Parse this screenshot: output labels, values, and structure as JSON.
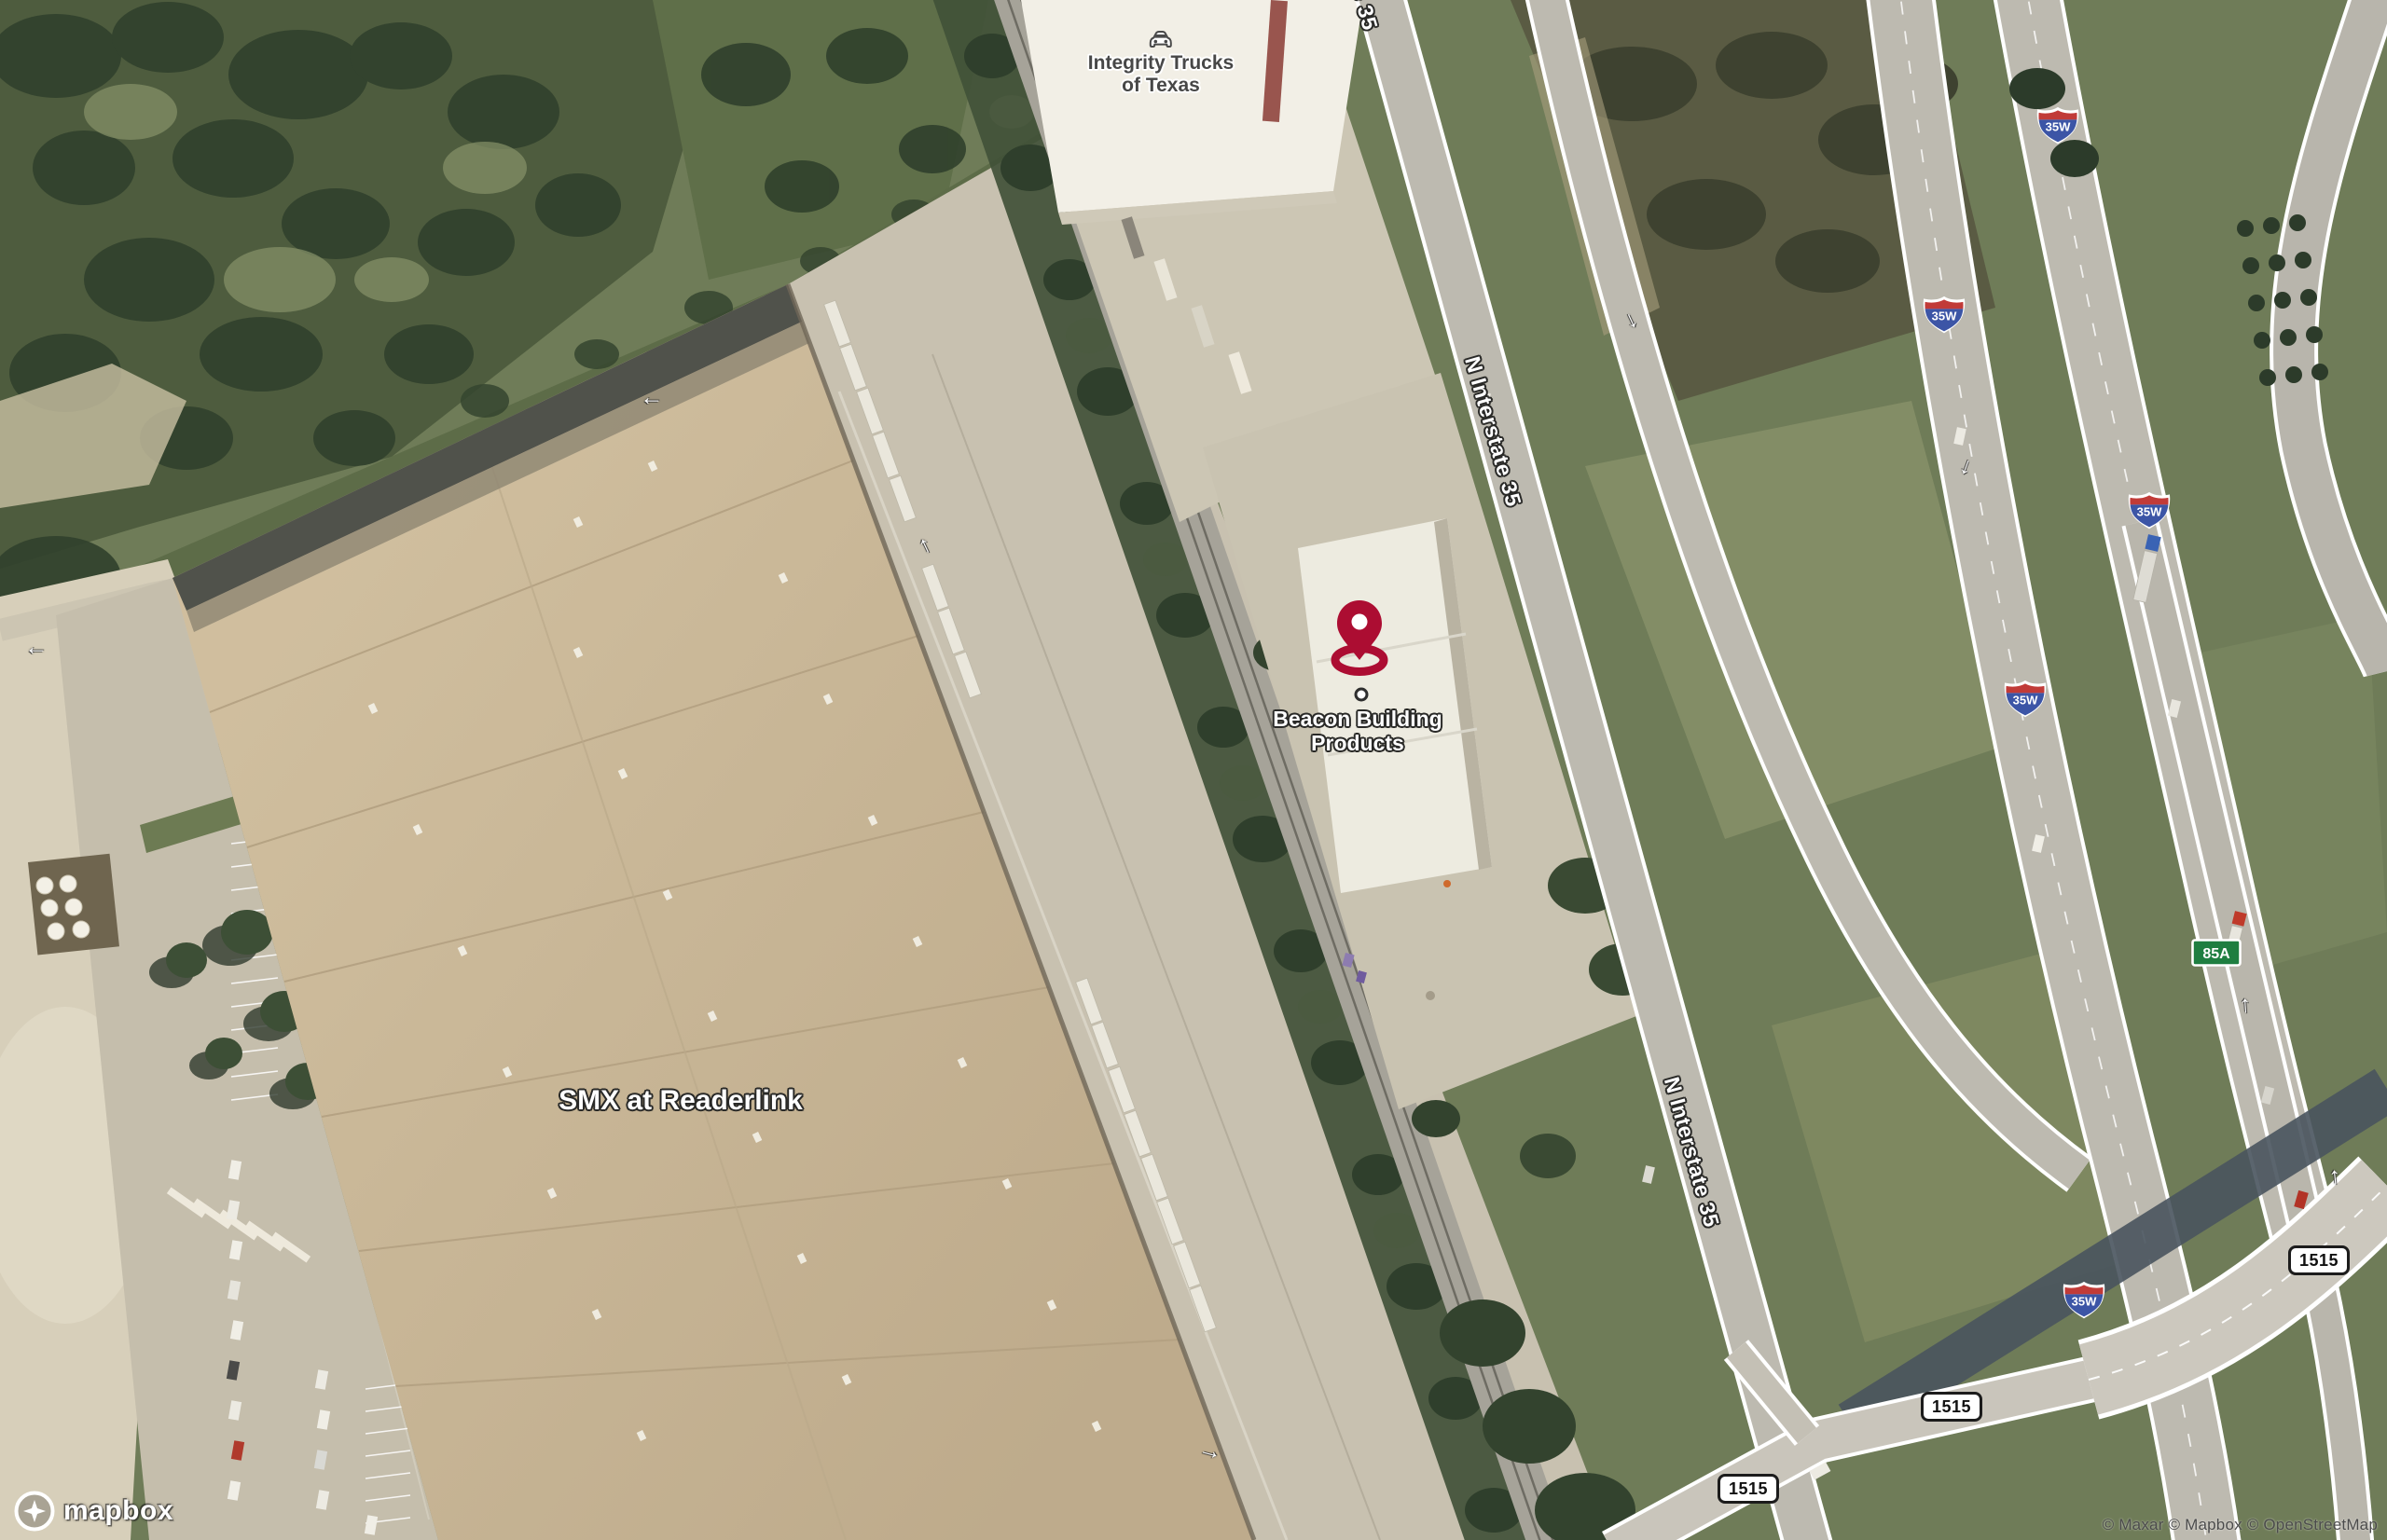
{
  "map": {
    "attribution_text": "© Maxar © Mapbox © OpenStreetMap",
    "logo_text": "mapbox"
  },
  "markers": {
    "beacon": {
      "line1": "Beacon Building",
      "line2": "Products"
    }
  },
  "poi_labels": {
    "integrity": {
      "line1": "Integrity Trucks",
      "line2": "of Texas"
    },
    "smx": {
      "label": "SMX at Readerlink"
    }
  },
  "road_labels": {
    "n_interstate_35": "N Interstate 35"
  },
  "shields": {
    "interstate": {
      "text": "35W"
    },
    "spur_green": {
      "text": "85A"
    },
    "fm_white": {
      "text": "1515"
    }
  },
  "glyphs": {
    "lane_arrow": "↑"
  },
  "icons": {
    "poi_icon": "car-icon",
    "marker_icon": "location-pin-icon",
    "logo_icon": "mapbox-logo-icon"
  },
  "colors": {
    "marker_pin": "#AC0D32",
    "shield_red": "#C13B38",
    "shield_blue": "#3C55A6",
    "shield_green": "#1E7E40"
  }
}
